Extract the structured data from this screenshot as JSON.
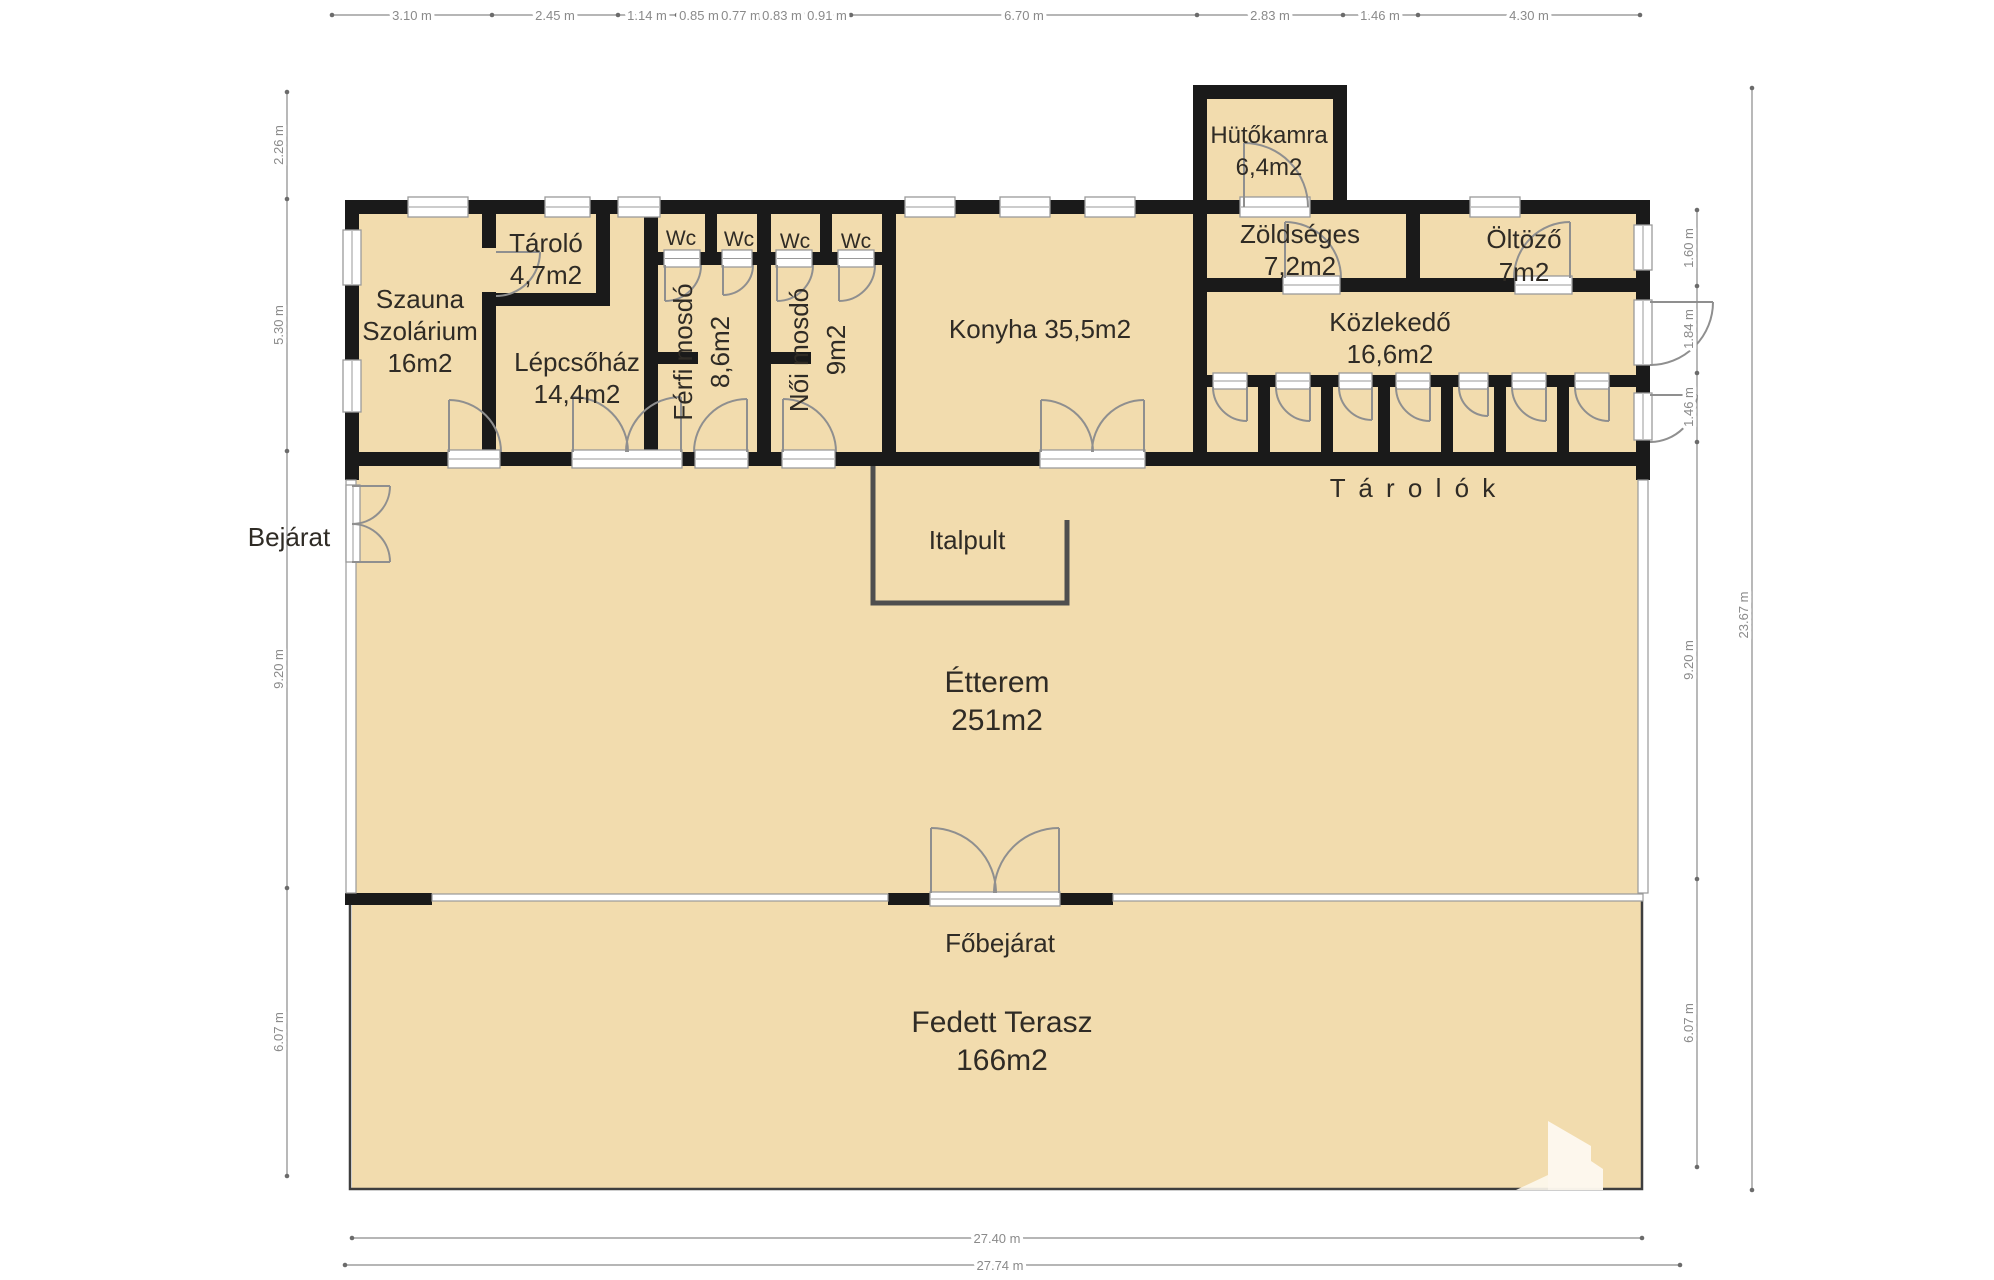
{
  "rooms": {
    "hutokamra": {
      "name": "Hütőkamra",
      "area": "6,4m2"
    },
    "zoldseges": {
      "name": "Zöldséges",
      "area": "7,2m2"
    },
    "oltozo": {
      "name": "Öltöző",
      "area": "7m2"
    },
    "kozlekedo": {
      "name": "Közlekedő",
      "area": "16,6m2"
    },
    "szauna": {
      "name_line1": "Szauna",
      "name_line2": "Szolárium",
      "area": "16m2"
    },
    "tarolo": {
      "name": "Tároló",
      "area": "4,7m2"
    },
    "lepcsohaz": {
      "name": "Lépcsőház",
      "area": "14,4m2"
    },
    "ferfi_mosdo": {
      "name": "Férfi mosdó",
      "area": "8,6m2"
    },
    "noi_mosdo": {
      "name": "Női mosdó",
      "area": "9m2"
    },
    "konyha": {
      "label": "Konyha 35,5m2"
    },
    "etterem": {
      "name": "Étterem",
      "area": "251m2"
    },
    "fedett_terasz": {
      "name": "Fedett Terasz",
      "area": "166m2"
    }
  },
  "annotations": {
    "wc": "Wc",
    "tarolok": "T á r o l ó k",
    "bejarat": "Bejárat",
    "fobejarat": "Főbejárat",
    "italpult": "Italpult"
  },
  "dimensions": {
    "top": [
      "3.10 m",
      "2.45 m",
      "1.14 m",
      "0.85 m",
      "0.77 m",
      "0.83 m",
      "0.91 m",
      "6.70 m",
      "2.83 m",
      "1.46 m",
      "4.30 m"
    ],
    "left": [
      "2.26 m",
      "5.30 m",
      "9.20 m",
      "6.07 m"
    ],
    "right": [
      "1.60 m",
      "1.84 m",
      "1.46 m",
      "9.20 m",
      "6.07 m"
    ],
    "right_total": "23.67 m",
    "bottom_inner": "27.40 m",
    "bottom_outer": "27.74 m"
  },
  "colors": {
    "room_fill": "#f2dcae",
    "wall": "#1a1a1a",
    "door_line": "#8f8f8f",
    "glass_line": "#9a9a9a",
    "text": "#2f2b25",
    "dim_text": "#8a8a8a"
  }
}
